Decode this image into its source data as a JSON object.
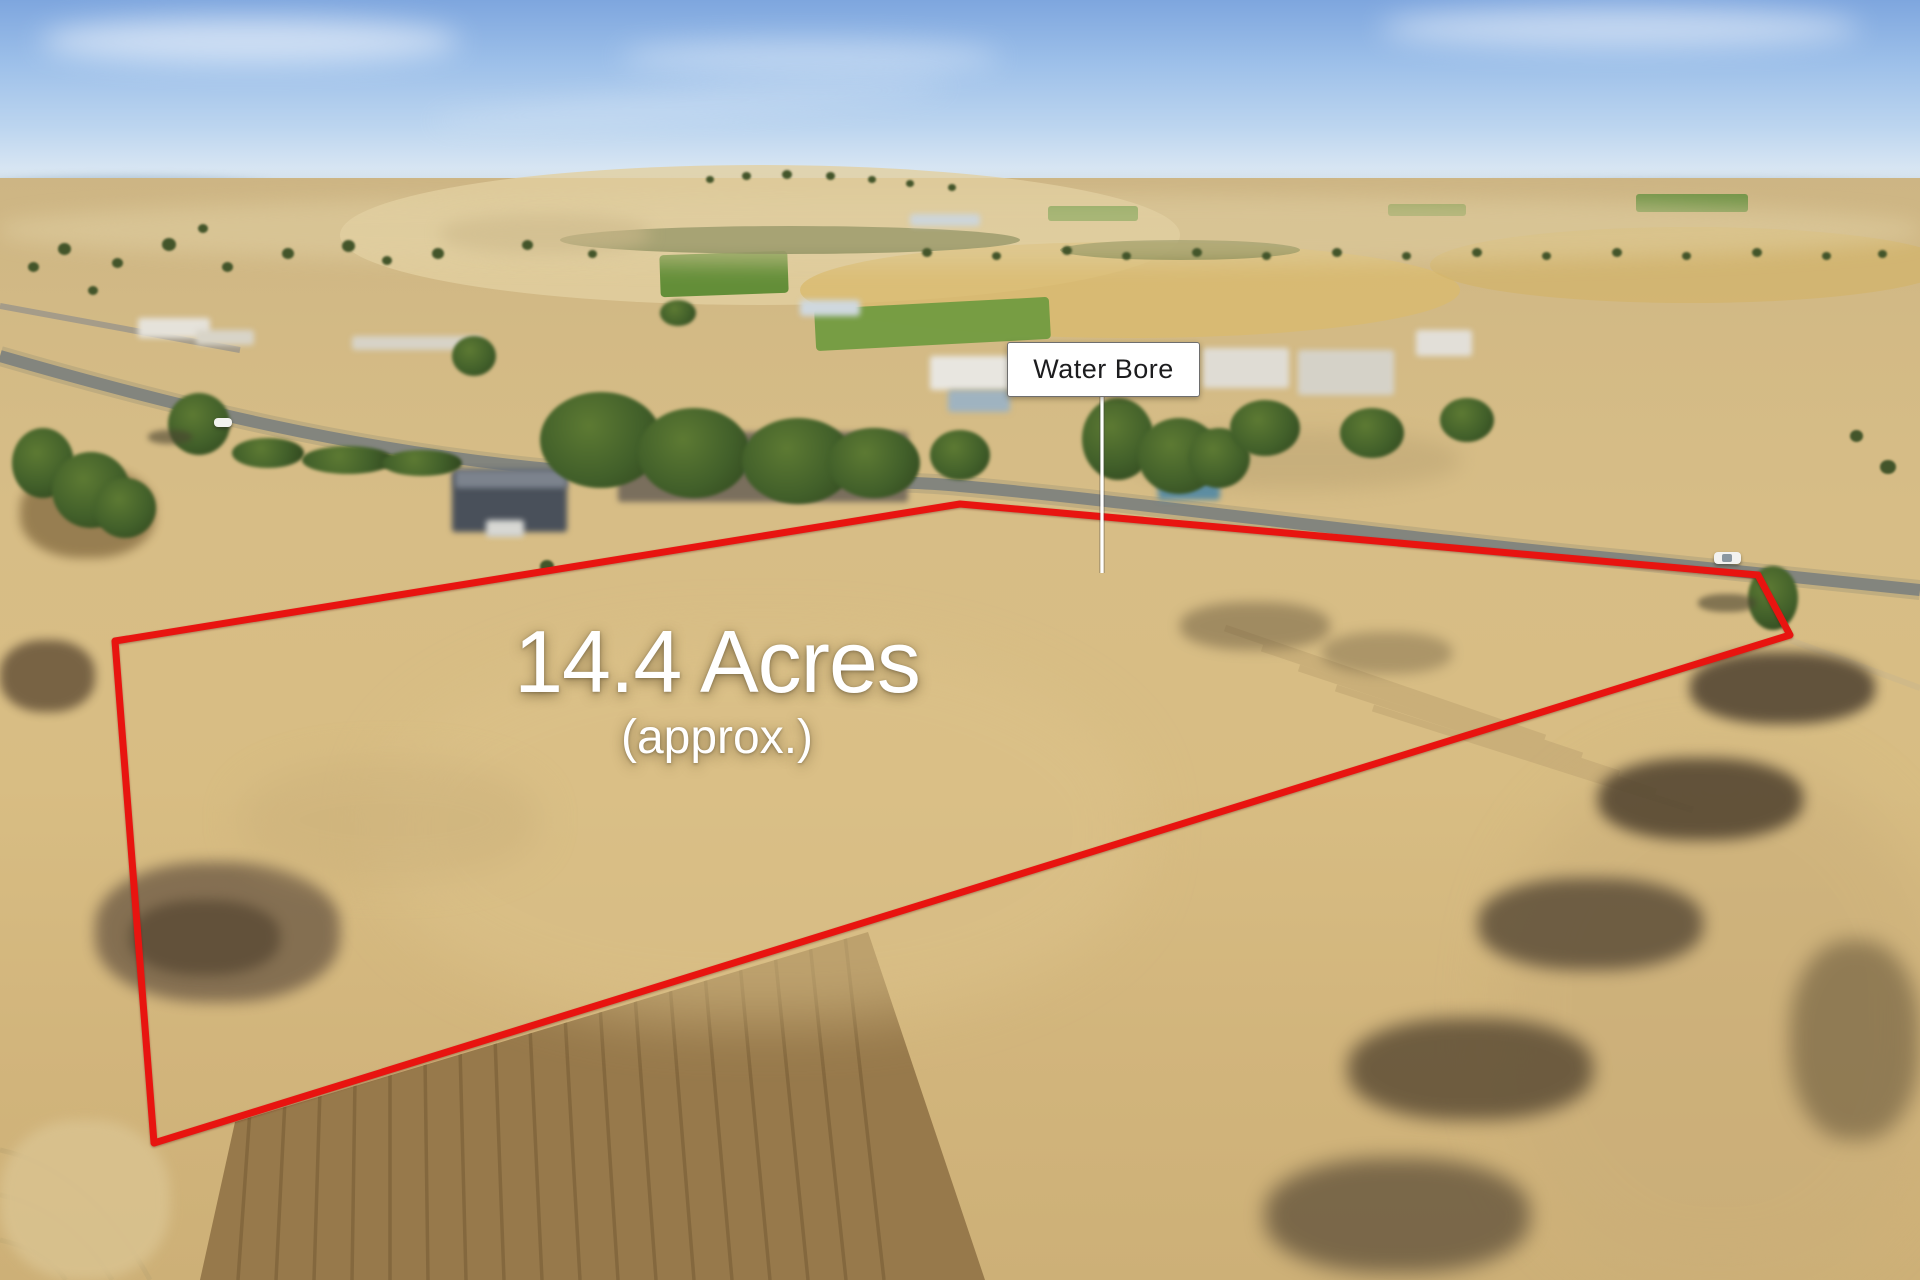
{
  "photo": {
    "description": "aerial-drone-photo-rural-acreage",
    "annotations": {
      "area_label": {
        "title": "14.4 Acres",
        "subtitle": "(approx.)"
      },
      "water_bore": {
        "label": "Water Bore"
      },
      "boundary": {
        "color": "#e81410",
        "stroke_width": 7,
        "points": "115,641 960,504 1758,575 1790,635 154,1143"
      }
    },
    "colors": {
      "overlay-text": "#ffffff",
      "bore-bg": "#ffffff",
      "bore-text": "#1c1c1e",
      "boundary-red": "#e81410",
      "sky-top": "#7ea6de",
      "sky-horizon": "#e8eff5",
      "field-base": "#d7bd86",
      "road-gray": "#8d8f88"
    }
  }
}
